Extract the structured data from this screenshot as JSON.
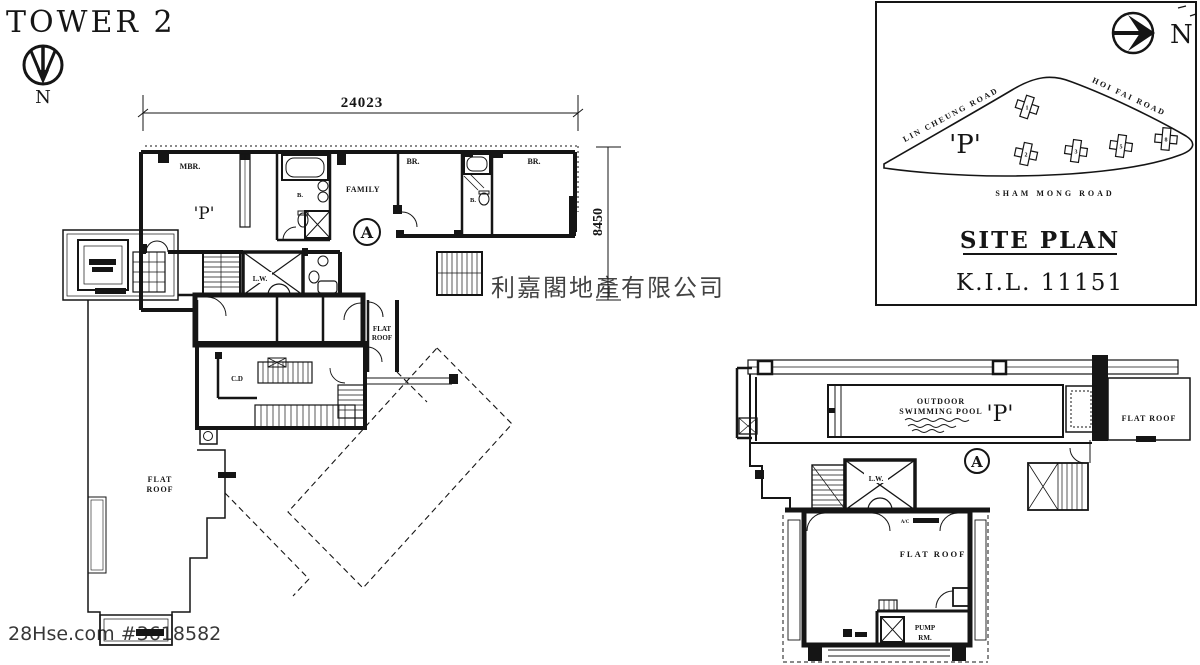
{
  "title": "TOWER 2",
  "compass": {
    "north": "N"
  },
  "site_compass": {
    "north": "N"
  },
  "dimensions": {
    "width": "24023",
    "height": "8450"
  },
  "watermarks": {
    "center": "利嘉閣地產有限公司",
    "corner": "28Hse.com #3618582"
  },
  "upper_plan": {
    "unit": "'P'",
    "flat": "A",
    "mbr": "MBR.",
    "bath1": "B.",
    "family": "FAMILY",
    "br1": "BR.",
    "bath2": "B.",
    "br2": "BR.",
    "lift_well": "L.W.",
    "cable_duct": "C.D",
    "flat_word": "FLAT",
    "roof_word": "ROOF",
    "planter": "PLANTER"
  },
  "site_plan": {
    "heading": "SITE PLAN",
    "lot": "K.I.L. 11151",
    "site_label": "'P'",
    "road_lin_cheung": "LIN CHEUNG ROAD",
    "road_hoi_fai": "HOI FAI ROAD",
    "road_sham_mong": "SHAM MONG ROAD",
    "towers": [
      "1",
      "2",
      "3",
      "5",
      "8"
    ]
  },
  "roof_plan": {
    "pool_line1": "OUTDOOR",
    "pool_line2": "SWIMMING POOL",
    "unit": "'P'",
    "flat": "A",
    "lift_well": "L.W.",
    "flat_roof_right": "FLAT ROOF",
    "flat_roof_main": "FLAT ROOF",
    "pump_line1": "PUMP",
    "pump_line2": "RM.",
    "ac_label": "A/C",
    "planter": "PLANTER"
  }
}
